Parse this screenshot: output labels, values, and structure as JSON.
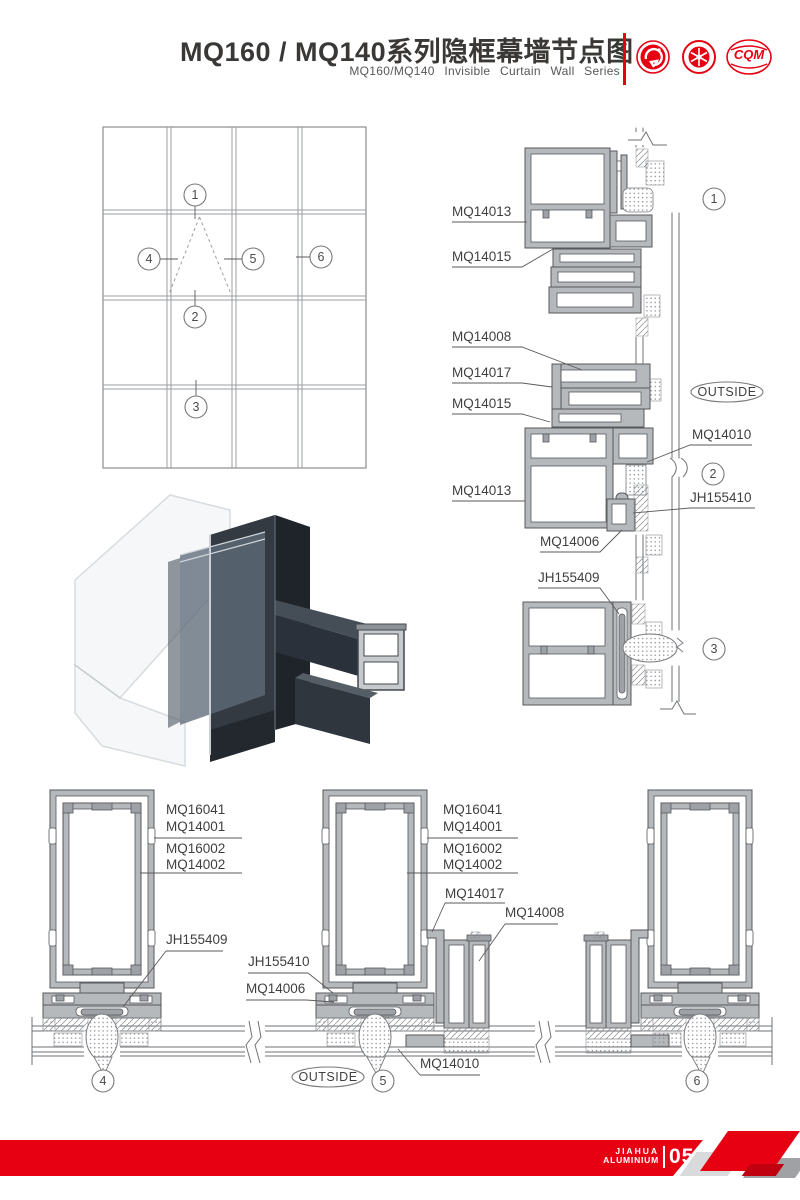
{
  "header": {
    "title": "MQ160 / MQ140系列隐框幕墙节点图",
    "subtitle": "MQ160/MQ140 Invisible Curtain Wall Series",
    "logo_cqm": "CQM"
  },
  "colors": {
    "accent_red": "#e60012"
  },
  "elevation": {
    "callouts": [
      "1",
      "2",
      "3",
      "4",
      "5",
      "6"
    ]
  },
  "sections": {
    "outside_label": "OUTSIDE",
    "right_labels": [
      "MQ14013",
      "MQ14015",
      "MQ14008",
      "MQ14017",
      "MQ14015",
      "MQ14013",
      "MQ14010",
      "JH155410",
      "MQ14006",
      "JH155409"
    ],
    "right_callouts": [
      "1",
      "2",
      "3"
    ],
    "bottom_callouts": [
      "4",
      "5",
      "6"
    ],
    "d4_labels": [
      "MQ16041",
      "MQ14001",
      "MQ16002",
      "MQ14002",
      "JH155409"
    ],
    "d5_labels": [
      "MQ16041",
      "MQ14001",
      "MQ16002",
      "MQ14002",
      "MQ14017",
      "MQ14008",
      "JH155410",
      "MQ14006",
      "MQ14010"
    ]
  },
  "footer": {
    "brand_line1": "JIAHUA",
    "brand_line2": "ALUMINIUM",
    "page_number": "05"
  }
}
